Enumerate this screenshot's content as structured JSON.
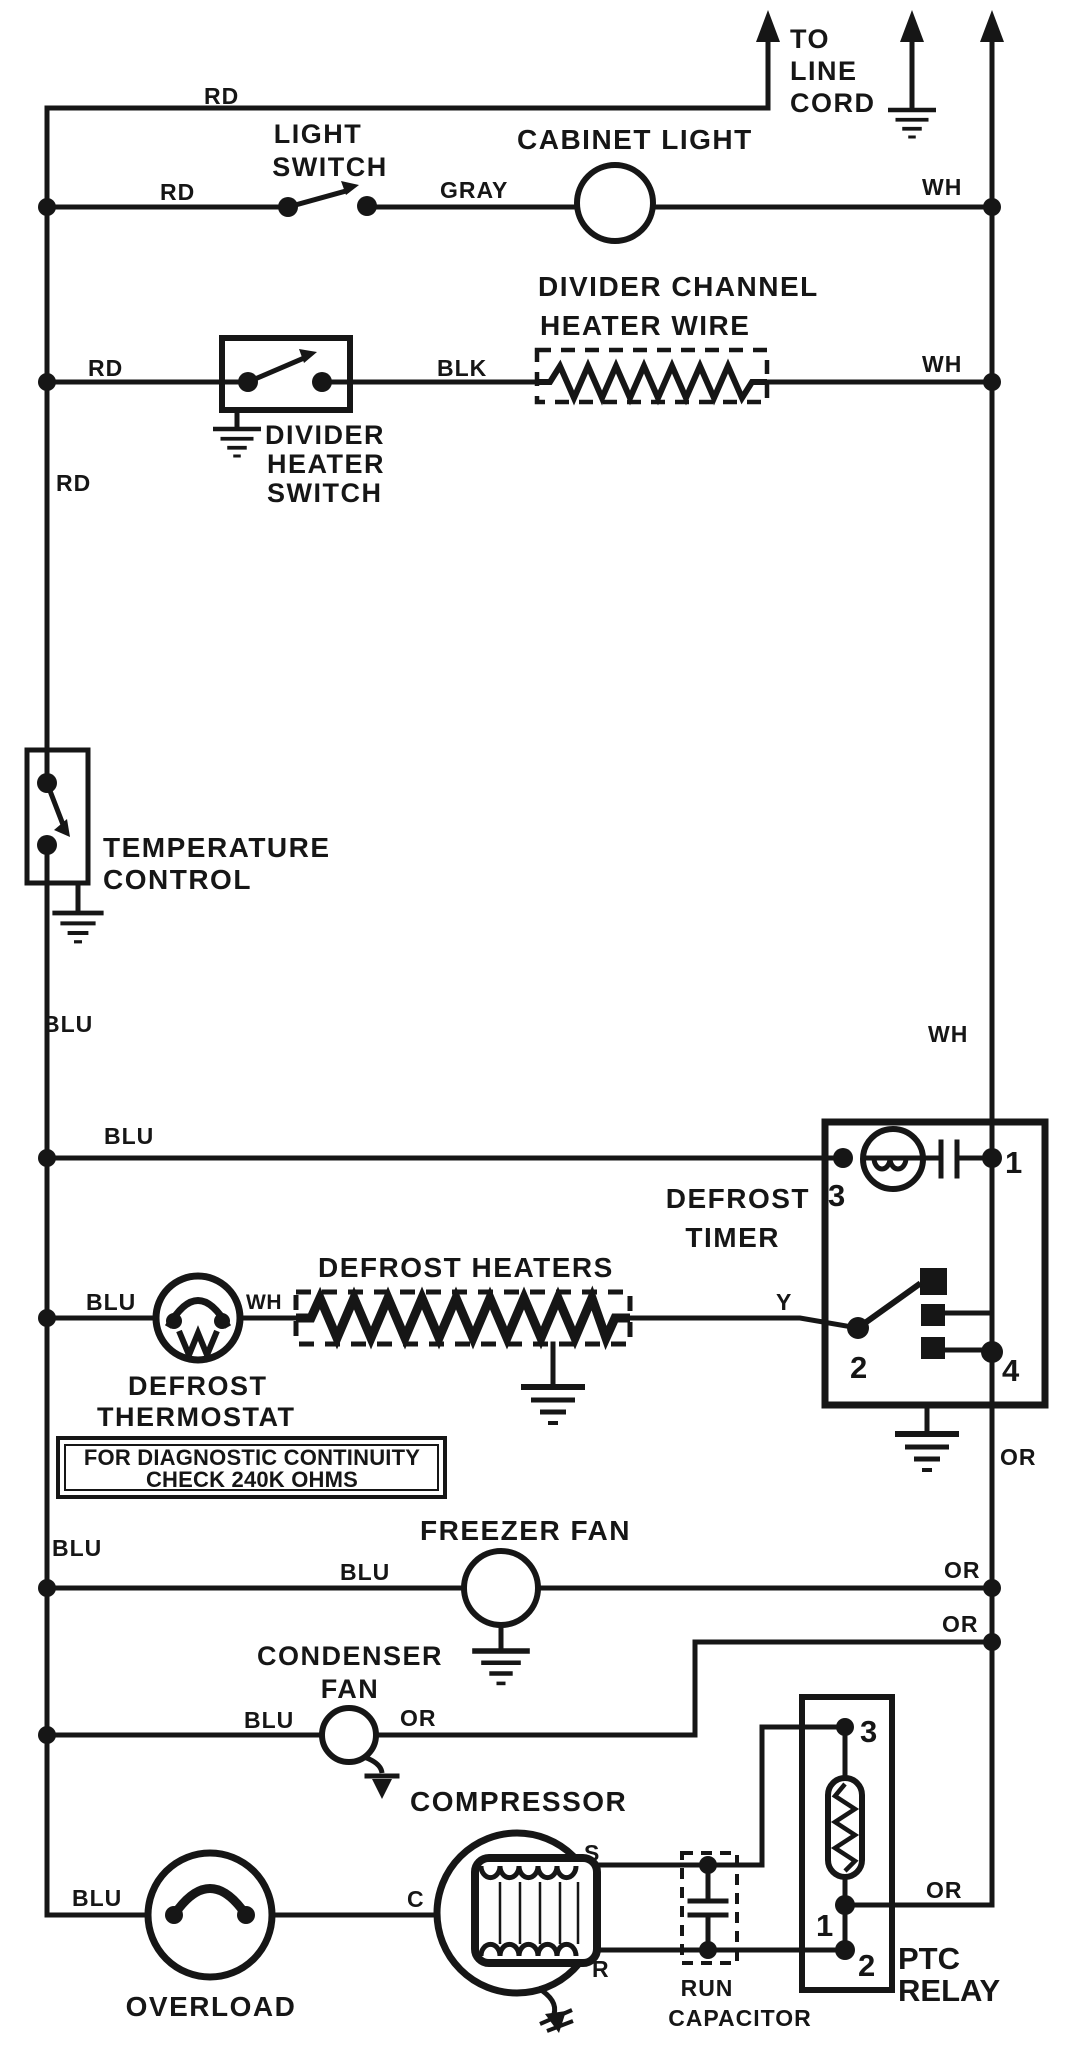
{
  "page": {
    "background": "#ffffff",
    "ink": "#161616"
  },
  "wire_labels": {
    "rd_top": "RD",
    "rd_light_row": "RD",
    "rd_divider_row": "RD",
    "rd_left_wire": "RD",
    "gray_light_row": "GRAY",
    "blk_divider_row": "BLK",
    "wh_light_row": "WH",
    "wh_divider_row": "WH",
    "wh_right_wire": "WH",
    "wh_thermostat": "WH",
    "blu_left_upper": "BLU",
    "blu_timer_row": "BLU",
    "blu_defrost_row": "BLU",
    "blu_left_lower": "BLU",
    "blu_freezer_row": "BLU",
    "blu_condenser_row": "BLU",
    "blu_overload_row": "BLU",
    "or_below_timer": "OR",
    "or_freezer_row": "OR",
    "or_condenser_jog": "OR",
    "or_condenser_fan": "OR",
    "or_ptc": "OR",
    "y_defrost": "Y"
  },
  "components": {
    "line_cord": {
      "line1": "TO",
      "line2": "LINE",
      "line3": "CORD"
    },
    "light_switch": {
      "line1": "LIGHT",
      "line2": "SWITCH"
    },
    "cabinet_light": {
      "label": "CABINET LIGHT"
    },
    "divider_channel_heater": {
      "line1": "DIVIDER CHANNEL",
      "line2": "HEATER WIRE"
    },
    "divider_heater_switch": {
      "line1": "DIVIDER",
      "line2": "HEATER",
      "line3": "SWITCH"
    },
    "temperature_control": {
      "line1": "TEMPERATURE",
      "line2": "CONTROL"
    },
    "defrost_timer": {
      "line1": "DEFROST",
      "line2": "TIMER",
      "terminal_1": "1",
      "terminal_2": "2",
      "terminal_3": "3",
      "terminal_4": "4"
    },
    "defrost_heaters": {
      "label": "DEFROST HEATERS"
    },
    "defrost_thermostat": {
      "line1": "DEFROST",
      "line2": "THERMOSTAT"
    },
    "diagnostic_note": {
      "line1": "FOR DIAGNOSTIC CONTINUITY",
      "line2": "CHECK 240K OHMS"
    },
    "freezer_fan": {
      "label": "FREEZER FAN"
    },
    "condenser_fan": {
      "line1": "CONDENSER",
      "line2": "FAN"
    },
    "compressor": {
      "label": "COMPRESSOR",
      "terminal_s": "S",
      "terminal_c": "C",
      "terminal_r": "R"
    },
    "overload": {
      "label": "OVERLOAD"
    },
    "run_capacitor": {
      "line1": "RUN",
      "line2": "CAPACITOR"
    },
    "ptc_relay": {
      "line1": "PTC",
      "line2": "RELAY",
      "terminal_1": "1",
      "terminal_2": "2",
      "terminal_3": "3"
    }
  }
}
